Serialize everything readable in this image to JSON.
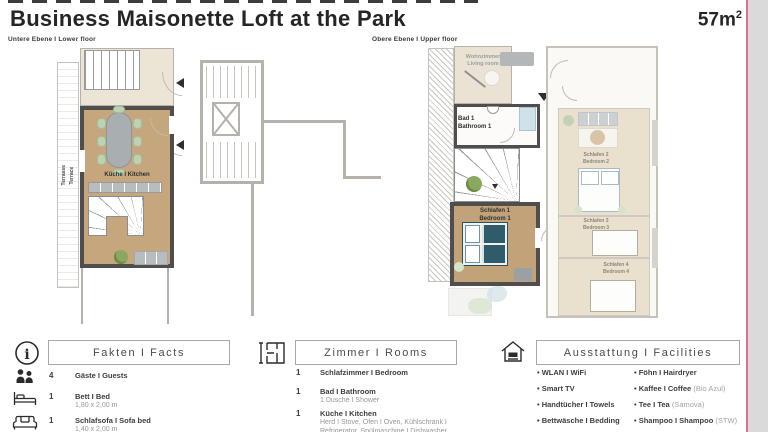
{
  "page": {
    "title": "Business Maisonette Loft at the Park",
    "area": "57m",
    "area_exp": "2"
  },
  "plans": {
    "lower_label": "Untere Ebene I Lower floor",
    "upper_label": "Obere Ebene I Upper floor",
    "kitchen": "Küche I Kitchen",
    "terrace": "Terrasse\nTerrace",
    "living": "Wohnzimmer\nLiving room",
    "bath1": "Bad 1\nBathroom 1",
    "bed1": "Schlafen 1\nBedroom 1",
    "bed2": "Schlafen 2\nBedroom 2",
    "bed3": "Schlafen 3\nBedroom 3",
    "bed4": "Schlafen 4\nBedroom 4"
  },
  "facts": {
    "header": "Fakten I Facts",
    "items": [
      {
        "qty": "4",
        "label": "Gäste I Guests",
        "sub": ""
      },
      {
        "qty": "1",
        "label": "Bett I Bed",
        "sub": "1,80 x 2,00 m"
      },
      {
        "qty": "1",
        "label": "Schlafsofa I Sofa bed",
        "sub": "1,40 x 2,00 m"
      }
    ]
  },
  "rooms": {
    "header": "Zimmer I Rooms",
    "items": [
      {
        "qty": "1",
        "label": "Schlafzimmer I Bedroom",
        "sub": ""
      },
      {
        "qty": "1",
        "label": "Bad I Bathroom",
        "sub": "1 Dusche I  Shower"
      },
      {
        "qty": "1",
        "label": "Küche I Kitchen",
        "sub": "Herd I Stove, Ofen I Oven, Kühlschrank I Refrigerator, Spülmaschine I Dishwasher"
      }
    ]
  },
  "facilities": {
    "header": "Ausstattung I Facilities",
    "col1": [
      "WLAN I WiFi",
      "Smart TV",
      "Handtücher I Towels",
      "Bettwäsche I Bedding"
    ],
    "col2": [
      {
        "main": "Föhn I Hairdryer",
        "note": ""
      },
      {
        "main": "Kaffee I Coffee",
        "note": "(Bio Azul)"
      },
      {
        "main": "Tee I Tea",
        "note": "(Samova)"
      },
      {
        "main": "Shampoo I Shampoo",
        "note": "(STW)"
      }
    ]
  },
  "icons": {
    "info_glyph": "i"
  },
  "colors": {
    "accent_line": "#e26e8f",
    "floor_tan": "#c6a67d",
    "floor_faded": "#e9e0cd",
    "wall_dark": "#4f4e4c",
    "wall_light": "#b5b2ac",
    "bed_teal": "#2e5c6b",
    "chair_green": "#bcd2b2",
    "right_strip_gray": "#dadada"
  }
}
